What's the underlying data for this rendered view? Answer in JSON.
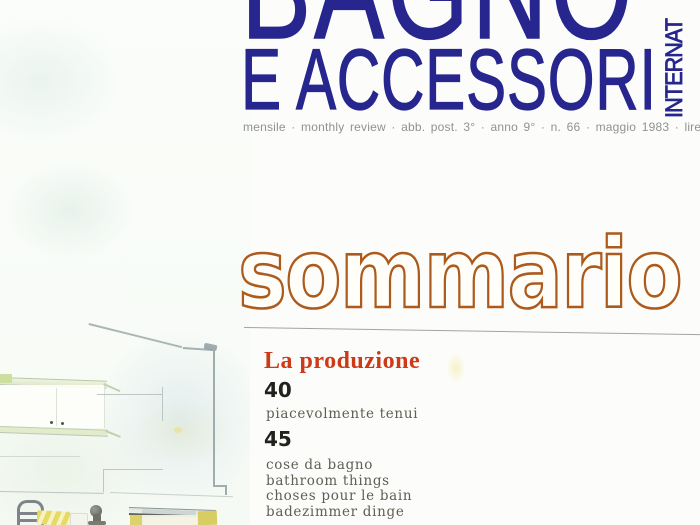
{
  "masthead": {
    "title_line1": "BAGNO",
    "title_line2": "E ACCESSORI",
    "vertical_text": "INTERNAT",
    "issue_line": "mensile · monthly review · abb. post. 3° · anno 9° · n. 66 · maggio 1983 · lire 3.500"
  },
  "contents": {
    "heading": "sommario",
    "section_title": "La produzione",
    "entries": [
      {
        "page": "40",
        "lines": [
          "piacevolmente tenui"
        ]
      },
      {
        "page": "45",
        "lines": [
          "cose da bagno",
          "bathroom things",
          "choses pour le bain",
          "badezimmer dinge"
        ]
      }
    ]
  },
  "illustration": {
    "description": "watercolor pencil sketch of a bathroom: wall shelves and cabinet, room corner line, towel stand, striped towels, faucet and washbasin vanity"
  },
  "colors": {
    "masthead_blue": "#26268e",
    "sommario_orange": "#ad5a1d",
    "section_red": "#cd3a18",
    "entry_number_black": "#21211d",
    "entry_text_gray": "#5e5e52",
    "issue_line_gray": "#8f938e",
    "sketch_yellow": "#ddd269",
    "sketch_line_gray": "#9fadad"
  }
}
